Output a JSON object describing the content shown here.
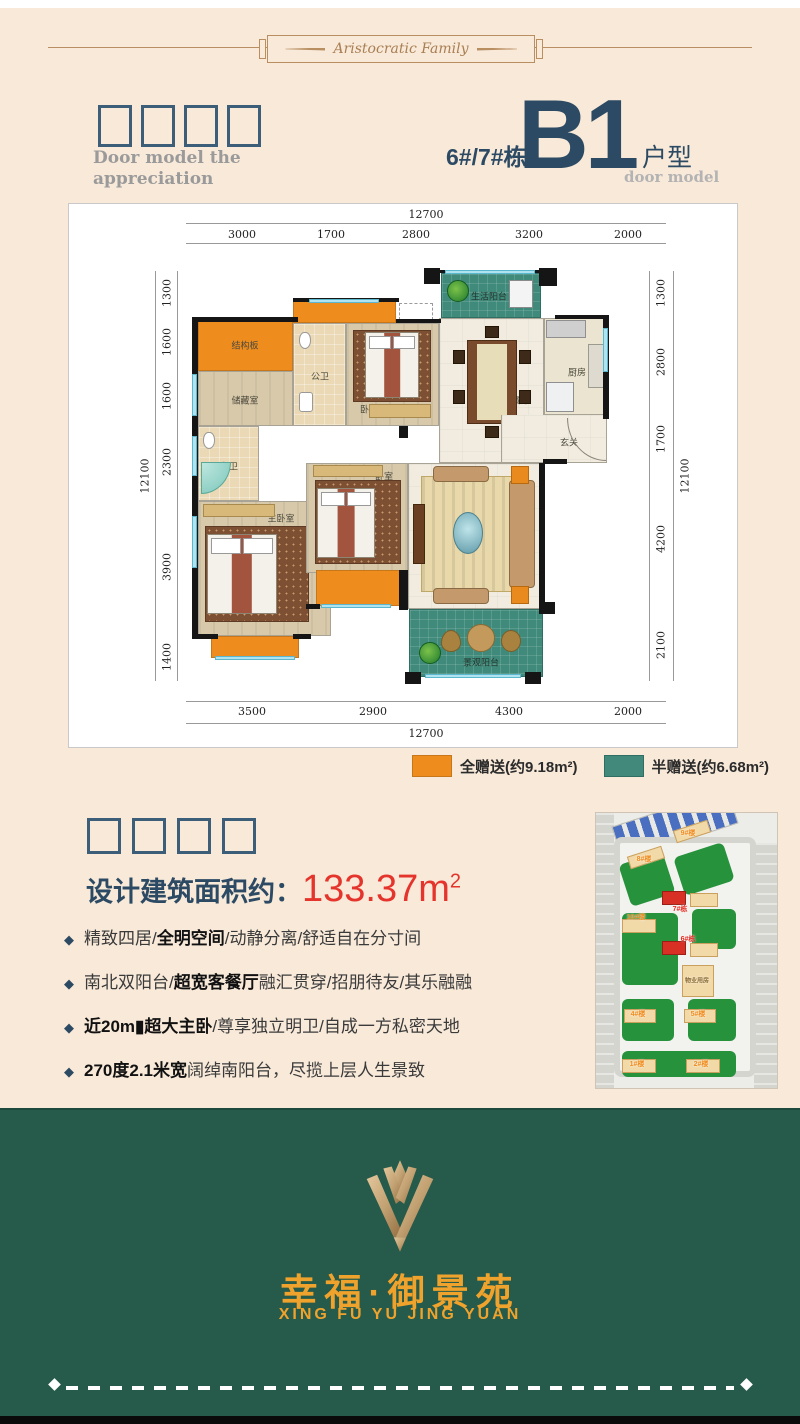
{
  "ornament": {
    "text": "Aristocratic Family"
  },
  "header": {
    "subtitle_en_line1": "Door model the",
    "subtitle_en_line2": "appreciation",
    "building": "6#/7#栋",
    "unit_code": "B1",
    "unit_type": "户型",
    "unit_type_en": "door model"
  },
  "plan": {
    "dims": {
      "top_total": "12700",
      "top": [
        "3000",
        "1700",
        "2800",
        "3200",
        "2000"
      ],
      "bottom": [
        "3500",
        "2900",
        "4300",
        "2000"
      ],
      "bottom_total": "12700",
      "left": [
        "1300",
        "1600",
        "1600",
        "2300",
        "3900",
        "1400"
      ],
      "left_total": "12100",
      "right": [
        "1300",
        "2800",
        "1700",
        "4200",
        "2100"
      ],
      "right_total": "12100"
    },
    "rooms": {
      "jiegouban": "结构板",
      "chucangshi": "储藏室",
      "gongwei": "公卫",
      "woshi_top": "卧室",
      "shenghuo_yangtai": "生活阳台",
      "canting": "餐厅",
      "chufang": "厨房",
      "xuanguan": "玄关",
      "zhuwei": "主卫",
      "zhuwoshi": "主卧室",
      "woshi_mid": "卧室",
      "keting": "客厅",
      "jingguan_yangtai": "景观阳台"
    },
    "legend": {
      "full": "全赠送(约9.18m²)",
      "half": "半赠送(约6.68m²)"
    }
  },
  "area": {
    "label": "设计建筑面积约：",
    "value": "133.37m",
    "sup": "2"
  },
  "features": [
    {
      "pre": "精致四居/",
      "bold": "全明空间",
      "post": "/动静分离/舒适自在分寸间"
    },
    {
      "pre": "南北双阳台/",
      "bold": "超宽客餐厅",
      "post": "融汇贯穿/招朋待友/其乐融融"
    },
    {
      "pre": "",
      "bold": "近20m▮超大主卧",
      "post": "/尊享独立明卫/自成一方私密天地"
    },
    {
      "pre": "",
      "bold": "270度2.1米宽",
      "post": "阔绰南阳台，尽揽上层人生景致"
    }
  ],
  "sitemap": {
    "labels": {
      "b9": "9#楼",
      "b8": "8#楼",
      "b7": "7#栋",
      "b10": "10#楼",
      "b6": "6#栋",
      "wuye": "物业用房",
      "b4": "4#楼",
      "b5": "5#楼",
      "b1": "1#楼",
      "b2": "2#楼"
    }
  },
  "footer": {
    "name_cn": "幸福·御景苑",
    "name_en": "XING FU YU JING YUAN"
  },
  "colors": {
    "background_cream": "#f8e9d9",
    "navy": "#2c4a63",
    "red_accent": "#e5342b",
    "orange_gift": "#ee8c1e",
    "teal_gift": "#43897b",
    "footer_green": "#265a4b",
    "gold": "#f0a32c",
    "ornament_brown": "#b98f62"
  }
}
